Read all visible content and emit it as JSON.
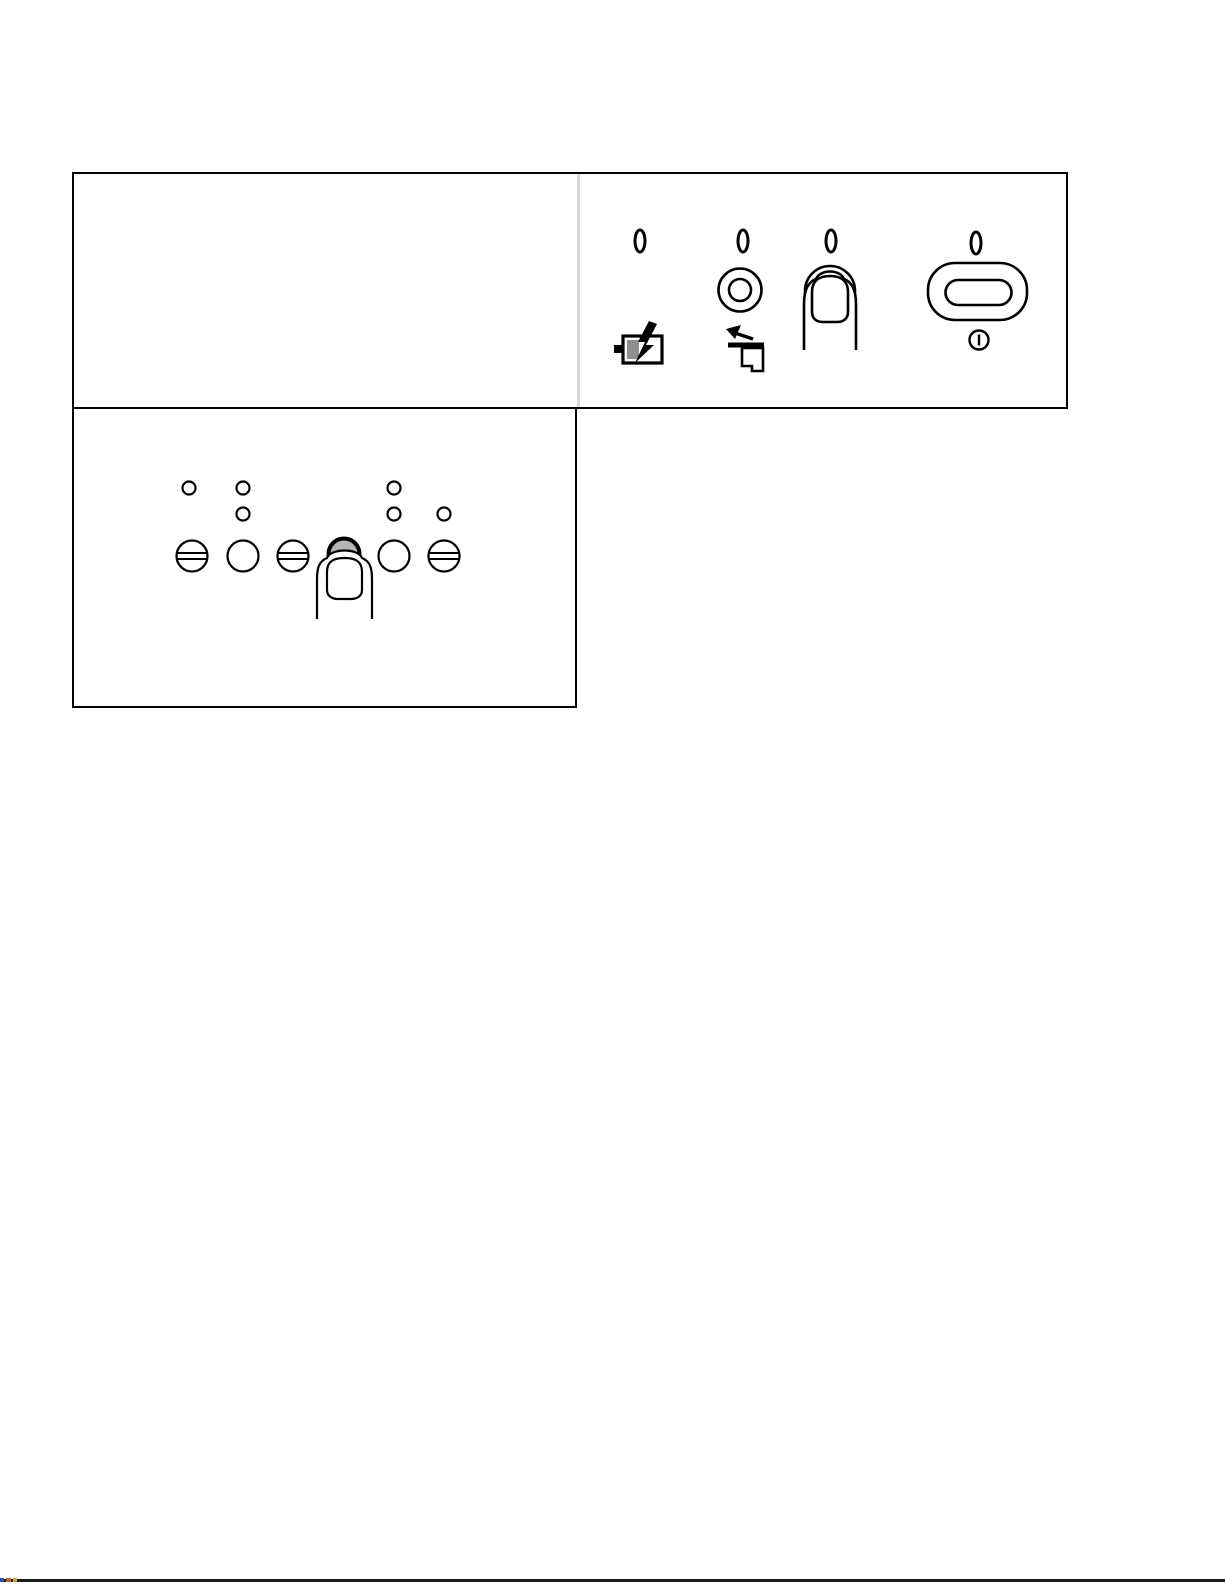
{
  "page": {
    "background": "#ffffff",
    "width_px": 1225,
    "height_px": 1585
  },
  "colors": {
    "outline": "#000000",
    "frame_border": "#000000",
    "panel_divider": "#d8d8d8",
    "pressed_button_fill": "#b5b5b5",
    "battery_level_fill": "#8f8f8f",
    "scan_line": "#1b1b1b",
    "scan_marks": [
      "#3a4fa0",
      "#b06a2e",
      "#c9a23a"
    ]
  },
  "top_panel_figure": {
    "leds": [
      {
        "name": "indicator-led-1"
      },
      {
        "name": "indicator-led-2"
      },
      {
        "name": "indicator-led-3"
      },
      {
        "name": "indicator-led-4"
      }
    ],
    "controls": [
      {
        "name": "ring-button",
        "shape": "concentric-circles"
      },
      {
        "name": "round-button-pressed-by-finger",
        "shape": "circle",
        "state": "pressed"
      },
      {
        "name": "power-button",
        "shape": "pill"
      }
    ],
    "icons": [
      {
        "name": "battery-charging-icon"
      },
      {
        "name": "film-eject-icon"
      },
      {
        "name": "power-symbol-icon"
      }
    ],
    "annotation": "finger-pressing-button"
  },
  "bottom_panel_figure": {
    "leds_row1_count": 3,
    "leds_row2_count": 3,
    "buttons": [
      {
        "name": "banded-button-1",
        "shape": "circle-with-double-line"
      },
      {
        "name": "plain-button-1",
        "shape": "circle"
      },
      {
        "name": "banded-button-2",
        "shape": "circle-with-double-line"
      },
      {
        "name": "pressed-button",
        "shape": "circle",
        "state": "pressed"
      },
      {
        "name": "plain-button-2",
        "shape": "circle"
      },
      {
        "name": "banded-button-3",
        "shape": "circle-with-double-line"
      }
    ],
    "annotation": "finger-pressing-button"
  }
}
